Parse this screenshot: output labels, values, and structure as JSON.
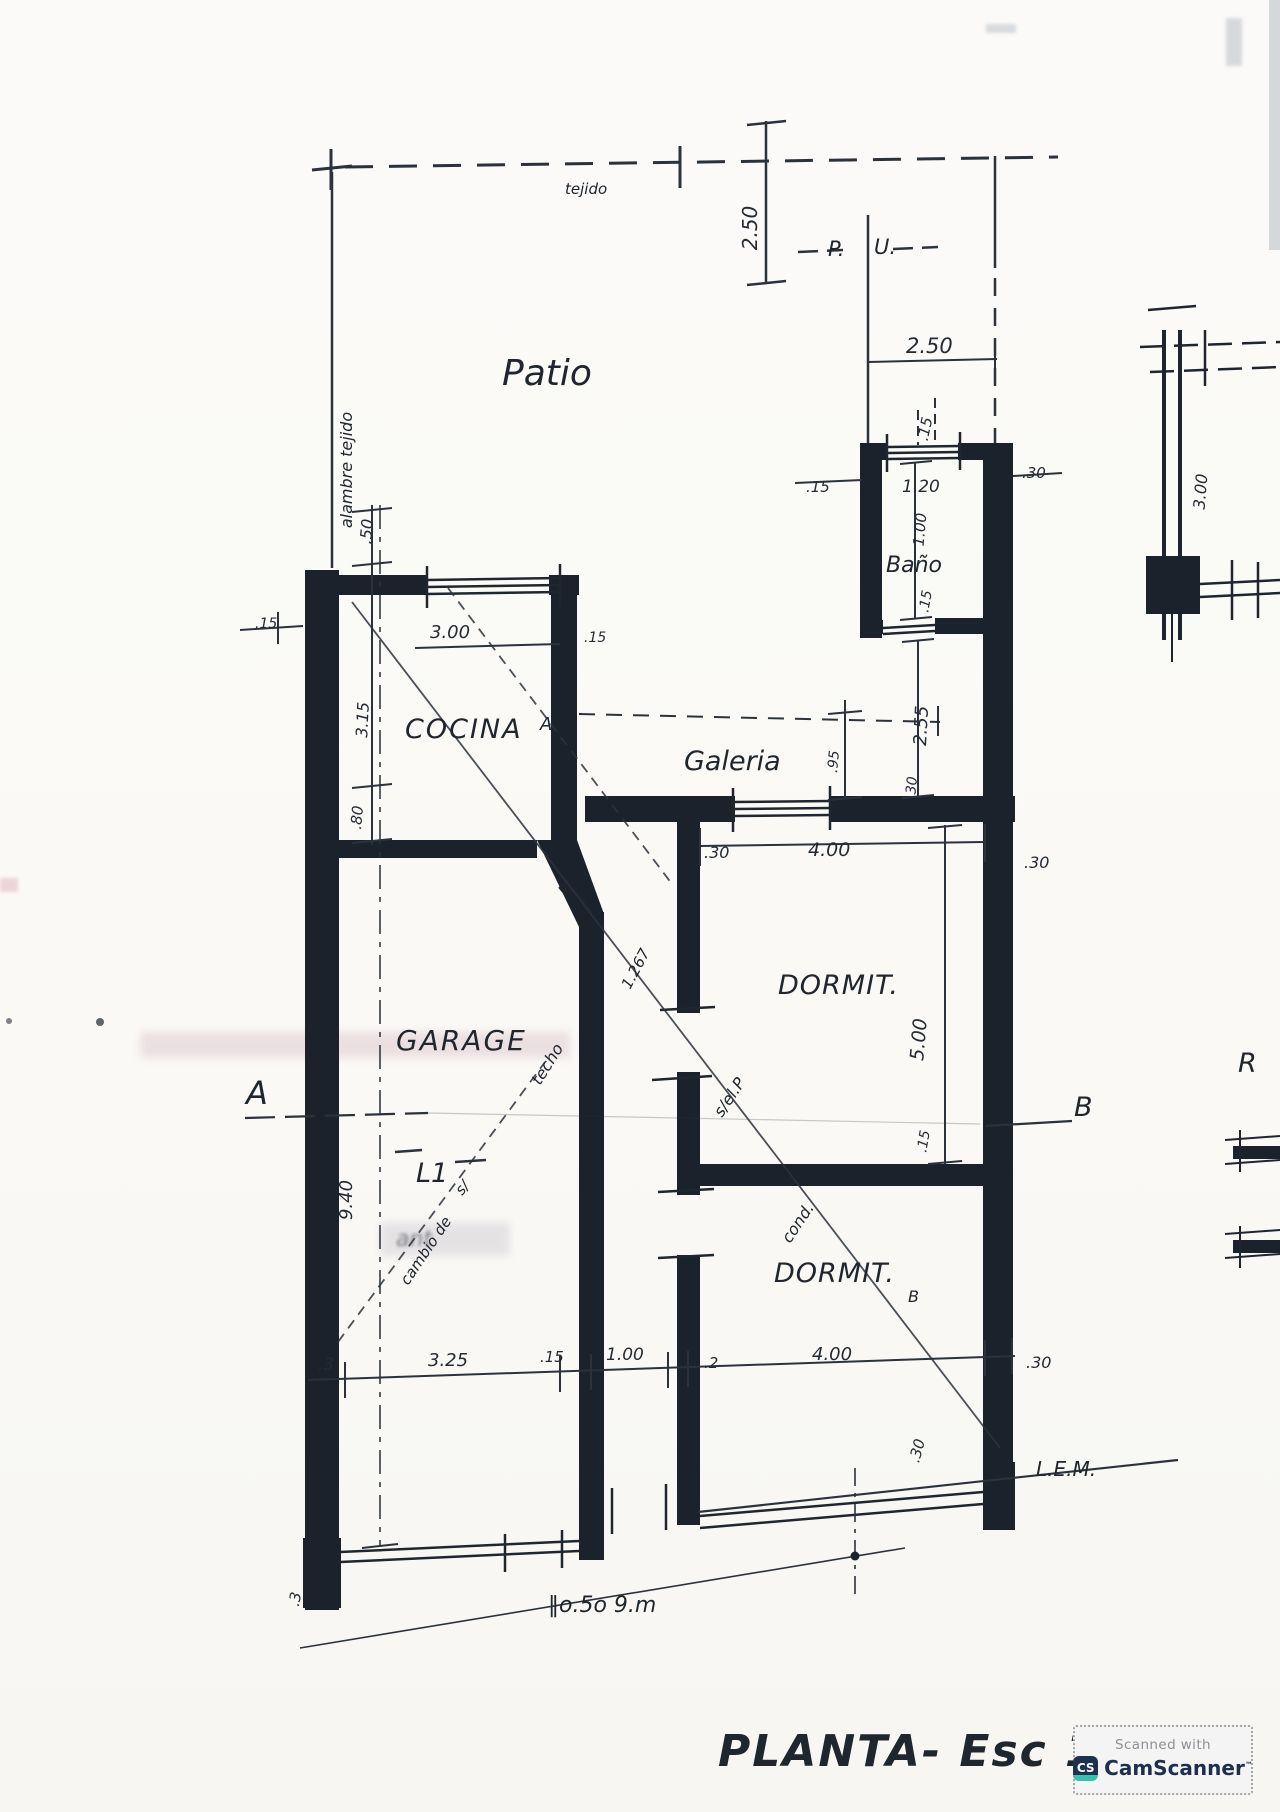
{
  "plan": {
    "title": "PLANTA-  Esc 1:100",
    "rooms": {
      "patio": "Patio",
      "cocina": "COCINA",
      "galeria": "Galeria",
      "bano": "Baño",
      "dormit1": "DORMIT.",
      "dormit2": "DORMIT.",
      "garage": "GARAGE"
    },
    "boundary": {
      "top_fence": "tejido",
      "left_fence": "alambre tejido",
      "gate_p": "P.",
      "gate_u": "U.",
      "lem": "L.E.M.",
      "lot_note": "‖o.5o  9.m"
    },
    "markers": {
      "section_a": "A",
      "section_b": "B",
      "beam": "L1",
      "beam_note": "s/",
      "door": "P",
      "galeria_a": "A",
      "small_b": "B",
      "fragment_r": "R"
    },
    "notes": {
      "techo": "techo",
      "cambio": "cambio de",
      "s_el_p": "s/el.P",
      "cond": "cond.",
      "n1267": "1.267",
      "bleed": "ant"
    },
    "dims": {
      "patio_h": "2.50",
      "patio_w": "2.50",
      "bano_top_t": ".15",
      "bano_w": "1.20",
      "bano_l_t": ".15",
      "bano_r_t": ".30",
      "bano_h": "1.00",
      "bano_b_t": ".15",
      "galeria_e": "2.55",
      "galeria_e_t": ".30",
      "galeria_h": ".95",
      "galeria_w_off": ".30",
      "galeria_w": "4.00",
      "galeria_w_t": ".30",
      "cocina_win": "3.00",
      "cocina_e_t": ".15",
      "cocina_l_t": ".15",
      "strip": ".50",
      "cocina_h": "3.15",
      "cocina_b": ".80",
      "dorm1_h": "5.00",
      "divider_t": ".15",
      "garage_h": "9.40",
      "b_left_t": ".3",
      "b_garage": "3.25",
      "b_wall1": ".15",
      "b_paso": "1.00",
      "b_wall2": ".2",
      "b_dorm": "4.00",
      "b_right_t": ".30",
      "b_corner": ".30",
      "b_foot": ".3",
      "frag": "3.00"
    }
  },
  "badge": {
    "scanned": "Scanned with",
    "brand": "CamScanner",
    "tm": "™",
    "cs": "CS"
  }
}
